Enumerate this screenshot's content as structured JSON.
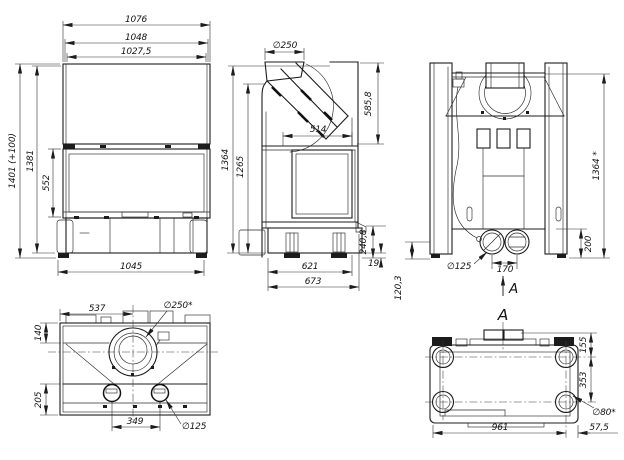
{
  "front": {
    "w1": "1076",
    "w2": "1048",
    "w3": "1027,5",
    "h_total": "1401 (+100)",
    "h_body": "1381",
    "h_door": "552",
    "w_base": "1045"
  },
  "side": {
    "flue": "∅250",
    "h_flue": "585,8",
    "depth_top": "514",
    "h_total": "1364",
    "h_mid": "1265",
    "h_bottom": "240,8",
    "feet": "19",
    "d_base": "621",
    "d_total": "673"
  },
  "rear": {
    "h_total": "1364 *",
    "h_conn": "200",
    "drain": "120,3",
    "conn": "∅125",
    "spacing": "170",
    "section": "A"
  },
  "top": {
    "flue_x": "537",
    "flue": "∅250*",
    "front_off": "140",
    "rear_off": "205",
    "spacing": "349",
    "outlet": "∅125"
  },
  "bottom": {
    "section": "A",
    "rear_off": "155",
    "feet_span": "353",
    "foot": "∅80*",
    "width": "961",
    "side_off": "57,5"
  }
}
